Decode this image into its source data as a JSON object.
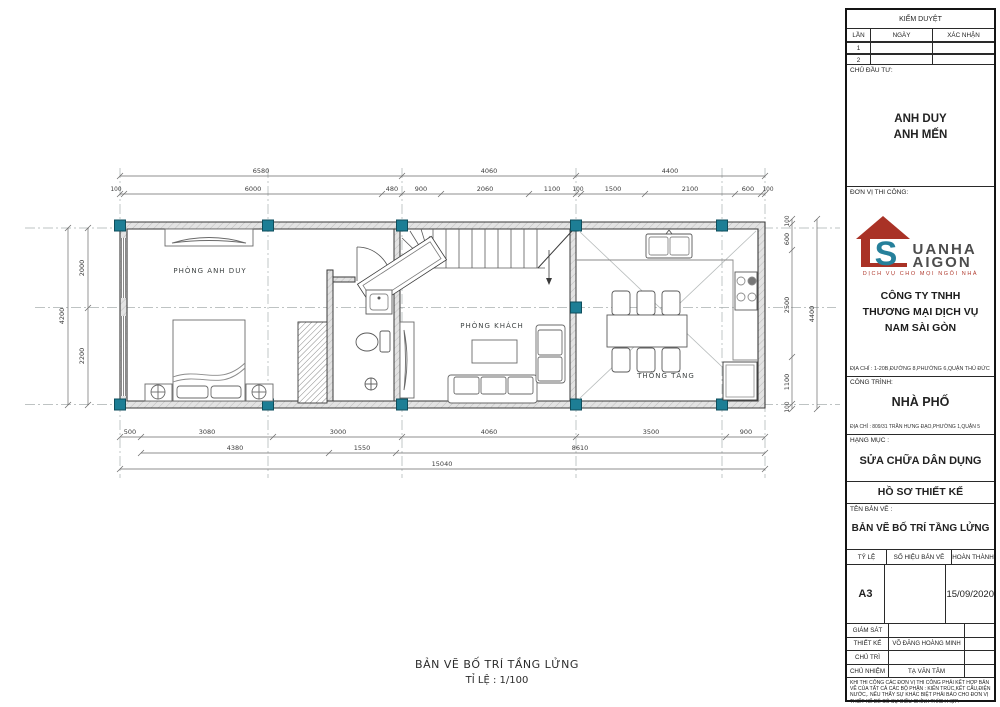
{
  "colors": {
    "column_teal": "#1d7e95",
    "logo_red": "#a93226",
    "logo_teal": "#26809b",
    "logo_gray": "#4d4d4d",
    "wall_gray": "#e3e3e3"
  },
  "plan": {
    "rooms": {
      "bedroom": "PHÒNG ANH DUY",
      "living": "PHÒNG KHÁCH",
      "void": "THÔNG TẦNG"
    },
    "dims": {
      "top1": [
        "6580",
        "4060",
        "4400"
      ],
      "top2": [
        "100",
        "6000",
        "480",
        "900",
        "2060",
        "1100",
        "100",
        "1500",
        "2100",
        "600",
        "100"
      ],
      "bottom1": [
        "500",
        "3080",
        "3000",
        "4060",
        "3500",
        "900"
      ],
      "bottom2": [
        "4380",
        "1550",
        "8610"
      ],
      "total": "15040",
      "left": [
        "2000",
        "2200"
      ],
      "left_total": "4200",
      "right": [
        "100",
        "600",
        "2500",
        "1100",
        "100"
      ],
      "right_total": "4400"
    },
    "caption_title": "BẢN VẼ BỐ TRÍ TẦNG LỬNG",
    "caption_scale": "TỈ LỆ : 1/100"
  },
  "titleblock": {
    "approval": {
      "title": "KIỂM DUYỆT",
      "col_lan": "LẦN",
      "col_ngay": "NGÀY",
      "col_xacnhan": "XÁC NHẬN",
      "row1": "1",
      "row2": "2"
    },
    "investor": {
      "label": "CHỦ ĐẦU TƯ:",
      "line1": "ANH DUY",
      "line2": "ANH MẾN"
    },
    "contractor": {
      "label": "ĐƠN VỊ THI CÔNG:",
      "logo_s": "S",
      "logo_top": "UANHA",
      "logo_bottom": "AIGON",
      "tagline": "DỊCH VỤ CHO MỌI NGÔI NHÀ",
      "company1": "CÔNG TY TNHH",
      "company2": "THƯƠNG MẠI DỊCH VỤ",
      "company3": "NAM SÀI GÒN",
      "address": "ĐỊA CHỈ : 1-20B,ĐƯỜNG 8,PHƯỜNG 6,QUẬN THỦ ĐỨC"
    },
    "project": {
      "label": "CÔNG TRÌNH:",
      "name": "NHÀ PHỐ",
      "address": "ĐỊA CHỈ : 809/31 TRẦN HƯNG ĐẠO,PHƯỜNG 1,QUẬN 5"
    },
    "category": {
      "label": "HẠNG MỤC :",
      "value": "SỬA CHỮA DÂN DỤNG"
    },
    "dossier": "HỒ SƠ THIẾT KẾ",
    "drawing": {
      "label": "TÊN BẢN VẼ :",
      "value": "BẢN VẼ BỐ TRÍ TẦNG LỬNG"
    },
    "meta": {
      "scale_label": "TỶ LỆ",
      "number_label": "SỐ HIỆU BẢN VẼ",
      "complete_label": "HOÀN THÀNH",
      "scale_value": "A3",
      "complete_value": "15/09/2020"
    },
    "staff": [
      {
        "label": "GIÁM SÁT",
        "value": ""
      },
      {
        "label": "THIẾT KẾ",
        "value": "VÕ ĐĂNG HOÀNG MINH"
      },
      {
        "label": "CHỦ TRÌ",
        "value": ""
      },
      {
        "label": "CHỦ NHIỆM",
        "value": "TẠ VĂN TÂM"
      }
    ],
    "note": "KHI THI CÔNG CÁC ĐƠN VỊ THI CÔNG PHẢI KẾT HỢP BẢN VẼ CỦA TẤT CẢ CÁC BỘ PHẬN : KIẾN TRÚC,KẾT CẤU,ĐIỆN NƯỚC,. NẾU THẤY SỰ KHÁC BIỆT PHẢI BÁO CHO ĐƠN VỊ THIẾT KẾ ĐỂ CÓ SỰ ĐIỀU CHỈNH THÍCH HỢP."
  }
}
